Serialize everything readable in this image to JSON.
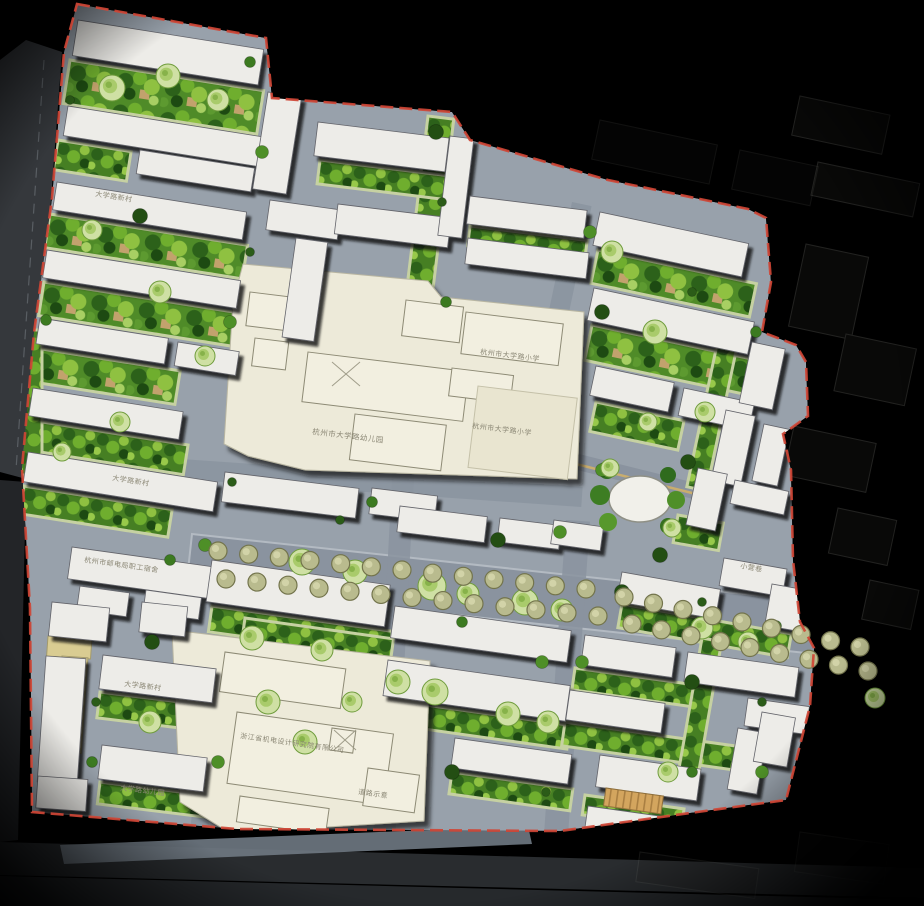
{
  "map": {
    "type": "residential-master-plan",
    "labels": [
      {
        "id": "daxue-xincun-north",
        "text": "大学路新村"
      },
      {
        "id": "daxue-xincun-west",
        "text": "大学路新村"
      },
      {
        "id": "kindergarten-main",
        "text": "杭州市大学路幼儿园"
      },
      {
        "id": "primary-school-upper",
        "text": "杭州市大学路小学"
      },
      {
        "id": "primary-school-lower",
        "text": "杭州市大学路小学"
      },
      {
        "id": "design-institute",
        "text": "浙江省机电设计研究院有限公司"
      },
      {
        "id": "west-office",
        "text": "杭州市邮电局职工宿舍"
      },
      {
        "id": "daxue-xincun-south",
        "text": "大学路新村"
      },
      {
        "id": "kindergarten-south",
        "text": "大学路幼儿园"
      },
      {
        "id": "road-note",
        "text": "道路示意"
      },
      {
        "id": "xiaoying-lane",
        "text": "小营巷"
      }
    ],
    "palette": {
      "background": "#000000",
      "boundary_red": "#cf4535",
      "road_gray": "#98a1ab",
      "street_gray": "#8a939f",
      "building_fill": "#edece8",
      "campus_cream": "#edead9",
      "garden_green": "#4f8b28",
      "tree_green_dark": "#2b5c18",
      "tree_green_bright": "#72b52e",
      "tree_pale": "#cfe0a4",
      "tree_olive": "#b9bb8e",
      "path_tan": "#d9cc92",
      "plaza_tan": "#d3a55e"
    }
  }
}
